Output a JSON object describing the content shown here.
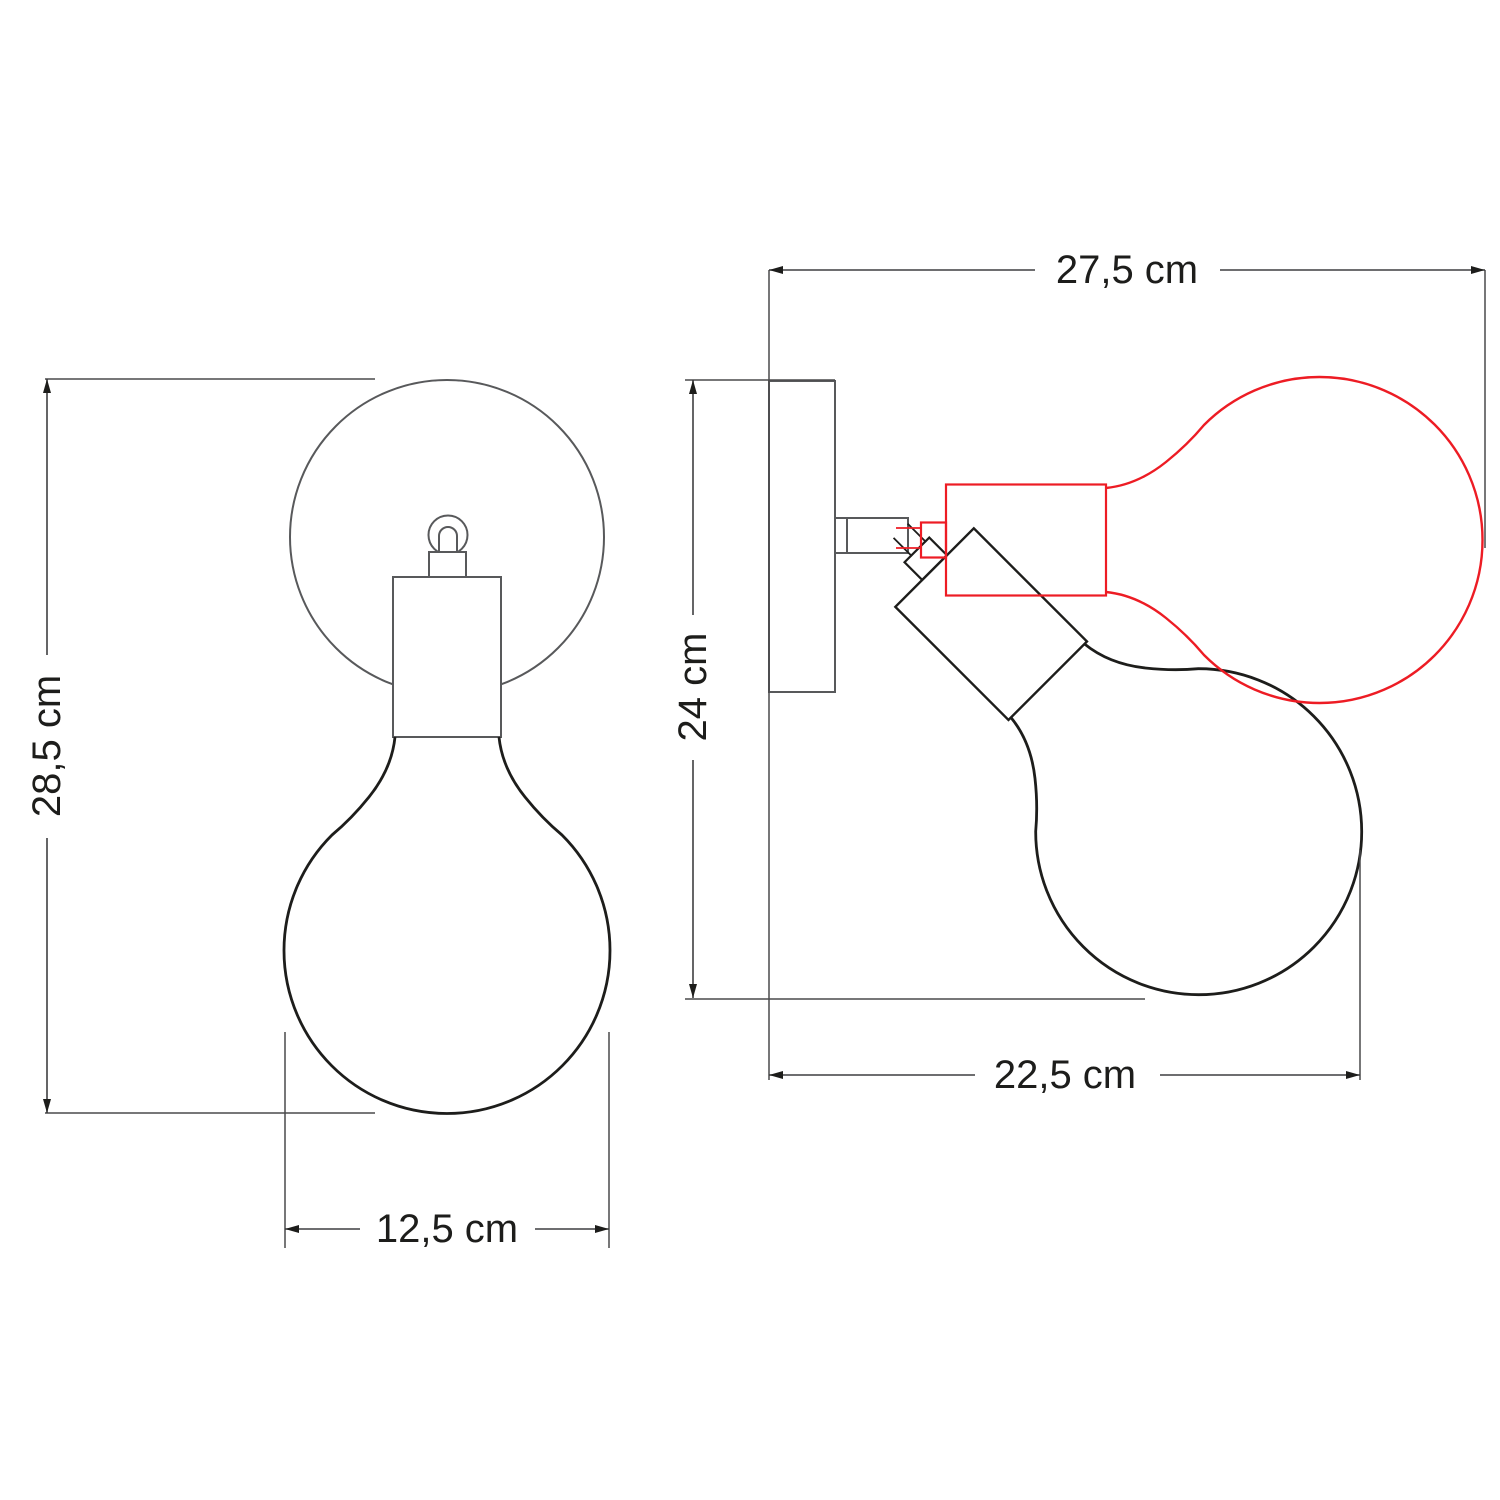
{
  "diagram": {
    "type": "technical-dimension-drawing",
    "subject": "adjustable wall lamp with globe bulb, front and side views",
    "views": {
      "front": {
        "name": "front-view",
        "dimensions": {
          "height": {
            "label": "28,5 cm",
            "axis": "vertical"
          },
          "width": {
            "label": "12,5 cm",
            "axis": "horizontal"
          }
        }
      },
      "side": {
        "name": "side-view",
        "alt_position_shown": true,
        "dimensions": {
          "depth_max": {
            "label": "27,5 cm",
            "axis": "horizontal"
          },
          "height": {
            "label": "24 cm",
            "axis": "vertical"
          },
          "depth_tilted": {
            "label": "22,5 cm",
            "axis": "horizontal"
          }
        }
      }
    },
    "colors": {
      "fixture_outline_gray": "#58595b",
      "bulb_outline_black": "#1d1d1b",
      "alt_position_red": "#ed1c24",
      "dimension_line": "#4a4a4c",
      "label_text": "#1d1d1b",
      "background": "#ffffff"
    }
  }
}
